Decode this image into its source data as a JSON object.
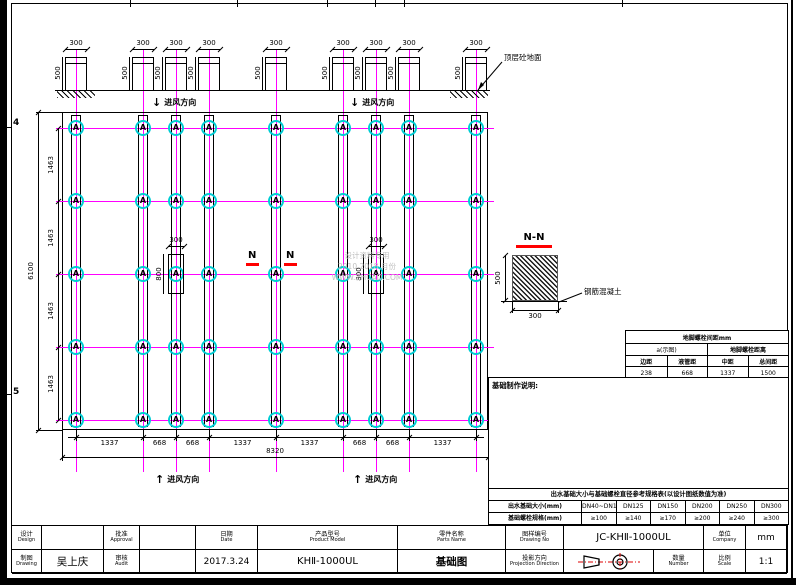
{
  "frame": {
    "left_zone_labels": [
      "4",
      "5"
    ]
  },
  "elevation": {
    "pedestal_width_label": "300",
    "pedestal_height_label": "500",
    "ground_label": "顶层砼地面",
    "airflow_label": "进风方向",
    "arrow_down": "↓",
    "arrow_up": "↑"
  },
  "plan": {
    "anchor_symbol": "A",
    "section_mark": "N",
    "detail_width_label": "300",
    "detail_height_label": "800",
    "left_segment_labels": [
      "1463",
      "1463",
      "1463",
      "1463"
    ],
    "left_total_label": "6100",
    "bottom_segment_labels": [
      "1337",
      "668",
      "668",
      "1337",
      "1337",
      "668",
      "668",
      "1337"
    ],
    "bottom_total_label": "8320"
  },
  "section": {
    "title": "N-N",
    "height_label": "500",
    "width_label": "300",
    "material_label": "钢筋混凝土"
  },
  "watermark": {
    "line1": "设计资料专用",
    "line2": "2010 2018 月份",
    "line3": "WWW.ZHCAD.COM"
  },
  "spacing_table": {
    "header": "地脚螺栓间距mm",
    "subs": [
      "a(示图)",
      "地脚螺栓距离"
    ],
    "cols": [
      "边距",
      "液管距",
      "中距",
      "总间距"
    ],
    "values": [
      "238",
      "668",
      "1337",
      "1500"
    ]
  },
  "notes": {
    "title": "基础制作说明:",
    "items": [
      "①. 基础平台水平误差±5mm，以水平尺或其他水平测量仪校平为准。",
      "②. 基础平面尺寸(←→)按冷冻管道接口方向进行设计尺寸，用户可根据管路布置情况调整，现场以实际尺寸为准，不得随意更改平台的产品管道中间距排列；内外管道接口左右交错布置时，用户如需调整请与本公司联系，给水及管系排布需留有检修通道间距，详见以上。",
      "③. 基础之间距(共享间)按标准接管方式布置安装，基础平台间距离应不小于图示安装尺寸。",
      "④. 基础表面上预埋钢板与预埋螺栓，出厂时按产品规格预埋好，钢板位置须保证预埋点方正及与螺栓交叉点位于平面内。",
      "⑤. 基础与地面保持垂直，安装人员按安装位置固定连接。",
      "⑥. 基础平台可采用本图纸标注尺寸做二次浇筑。",
      "⑦. 施工基础时，基础施工须与预留的预埋件位置尺寸符合产品接线安装要求，不得随意更改项目；因本公司原因除外事先通知，否则概不负责人员及安全事故。"
    ]
  },
  "size_table": {
    "header": "出水基础大小与基础螺栓直径参考规格表(以设计图纸数值为准)",
    "rows": [
      {
        "label": "出水基础大小(mm)",
        "values": [
          "DN40~DN100",
          "DN125",
          "DN150",
          "DN200",
          "DN250",
          "DN300"
        ]
      },
      {
        "label": "基础螺栓规格(mm)",
        "values": [
          "≥100",
          "≥140",
          "≥170",
          "≥200",
          "≥240",
          "≥300"
        ]
      }
    ]
  },
  "title_block": {
    "design": {
      "cn": "设计",
      "en": "Design"
    },
    "drawing": {
      "cn": "制图",
      "en": "Drawing"
    },
    "approval": {
      "cn": "批准",
      "en": "Approval"
    },
    "audit": {
      "cn": "审核",
      "en": "Audit"
    },
    "date": {
      "cn": "日期",
      "en": "Date"
    },
    "product_model": {
      "cn": "产品型号",
      "en": "Product Model"
    },
    "parts_name": {
      "cn": "零件名称",
      "en": "Parts Name"
    },
    "drawing_no": {
      "cn": "图样编号",
      "en": "Drawing No"
    },
    "company": {
      "cn": "单位",
      "en": "Company"
    },
    "projection": {
      "cn": "投影方向",
      "en": "Projection Direction"
    },
    "number": {
      "cn": "数量",
      "en": "Number"
    },
    "scale": {
      "cn": "比例",
      "en": "Scale"
    },
    "values": {
      "drawer": "吴上庆",
      "date": "2017.3.24",
      "product_model": "KHⅡ-1000UL",
      "parts_name": "基础图",
      "drawing_no": "JC-KHⅡ-1000UL",
      "unit": "mm",
      "scale": "1:1"
    }
  }
}
